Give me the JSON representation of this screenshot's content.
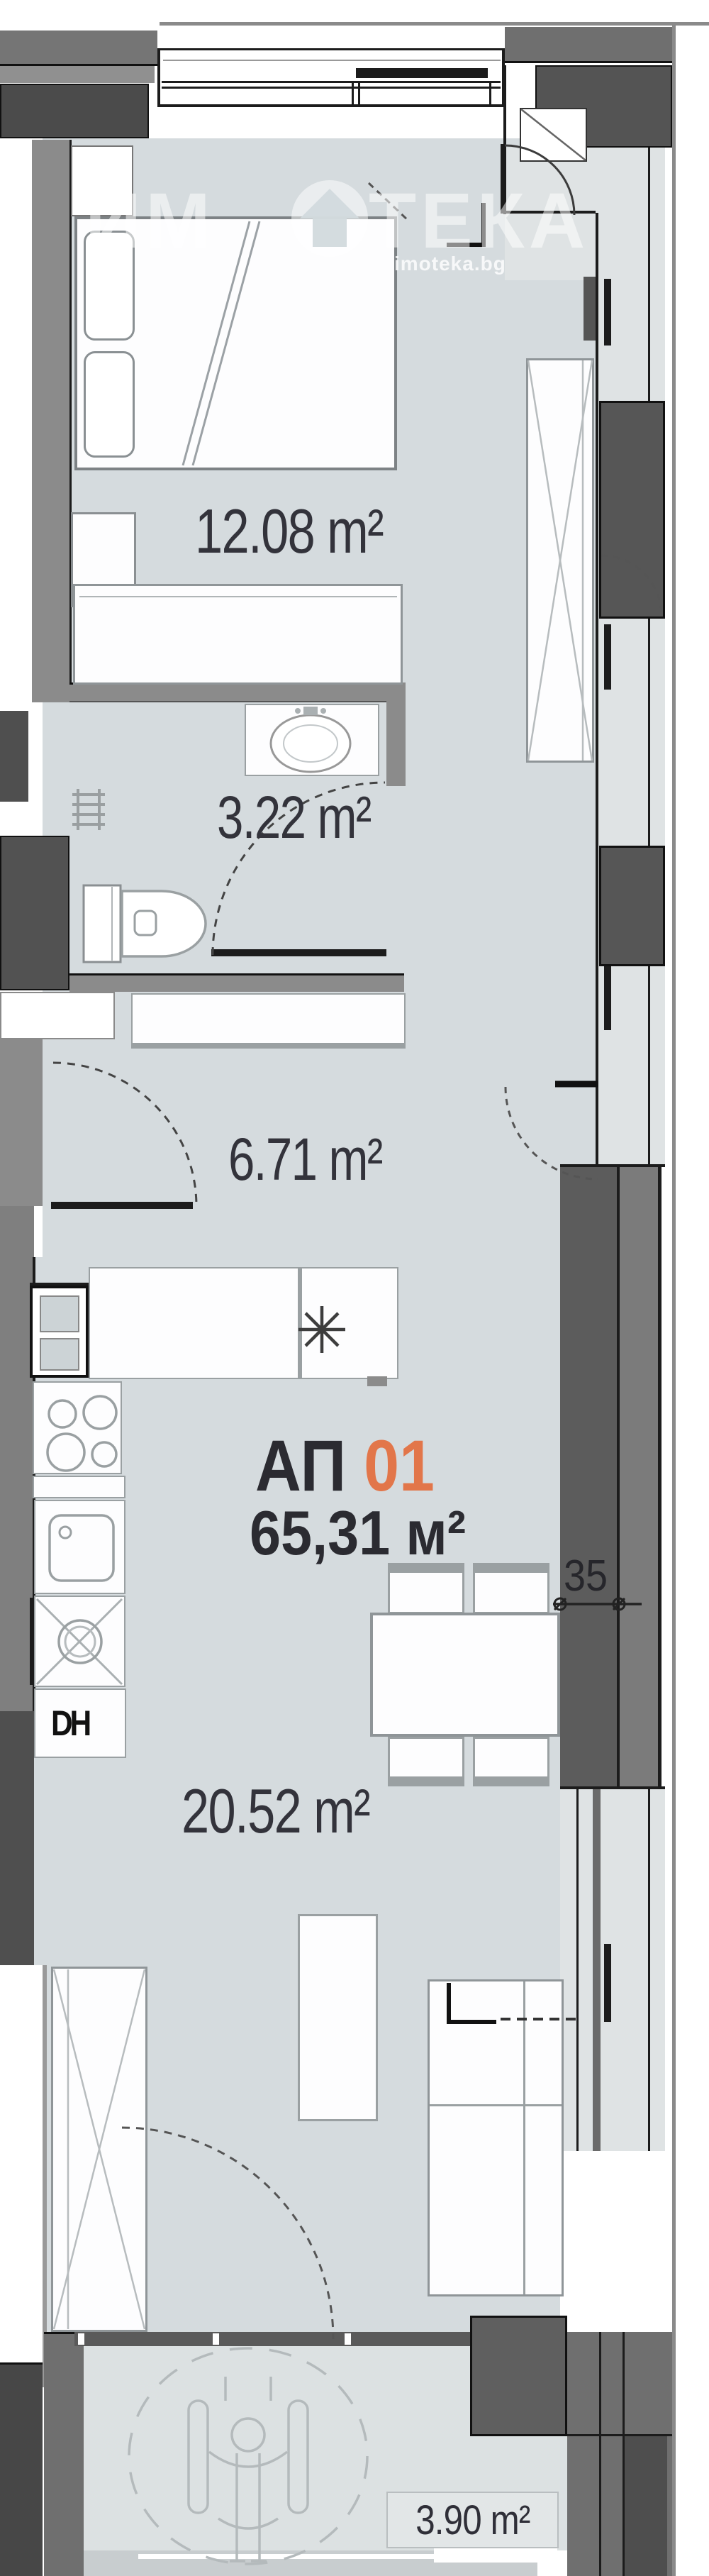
{
  "meta": {
    "type": "apartment-floor-plan"
  },
  "unit": {
    "label_prefix": "АП",
    "label_number": "01",
    "total_area": "65,31 м²"
  },
  "rooms": {
    "bedroom": {
      "area": "12.08 m²"
    },
    "bathroom": {
      "area": "3.22 m²"
    },
    "hallway": {
      "area": "6.71 m²"
    },
    "living_kitchen": {
      "area": "20.52 m²"
    },
    "terrace": {
      "area": "3.90 m²"
    }
  },
  "dimensions": {
    "wall_width": "35"
  },
  "appliances": {
    "dishwasher": "DH"
  },
  "watermark": {
    "brand": "ИМОТЕКА",
    "brand_left": "ИМ",
    "brand_right": "ТЕКА",
    "domain": "imoteka.bg"
  },
  "icons": {
    "boiler": "asterisk-star-icon",
    "accessibility": "wheelchair-icon",
    "dimension_tick": "circle-slash-icon",
    "burners": "stove-burner-circles-icon",
    "basin": "oval-washbasin-icon",
    "wc": "toilet-icon"
  },
  "colors": {
    "accent": "#e2764a",
    "label": "#33333b",
    "floor": "#d5dbde",
    "balcony_floor": "#dfe3e4",
    "wall_dark": "#4f4f4f",
    "wall_medium": "#6f6f6f",
    "wall_light": "#8b8b8b",
    "line": "#1c1c1c",
    "watermark": "rgba(255,255,255,0.52)"
  }
}
